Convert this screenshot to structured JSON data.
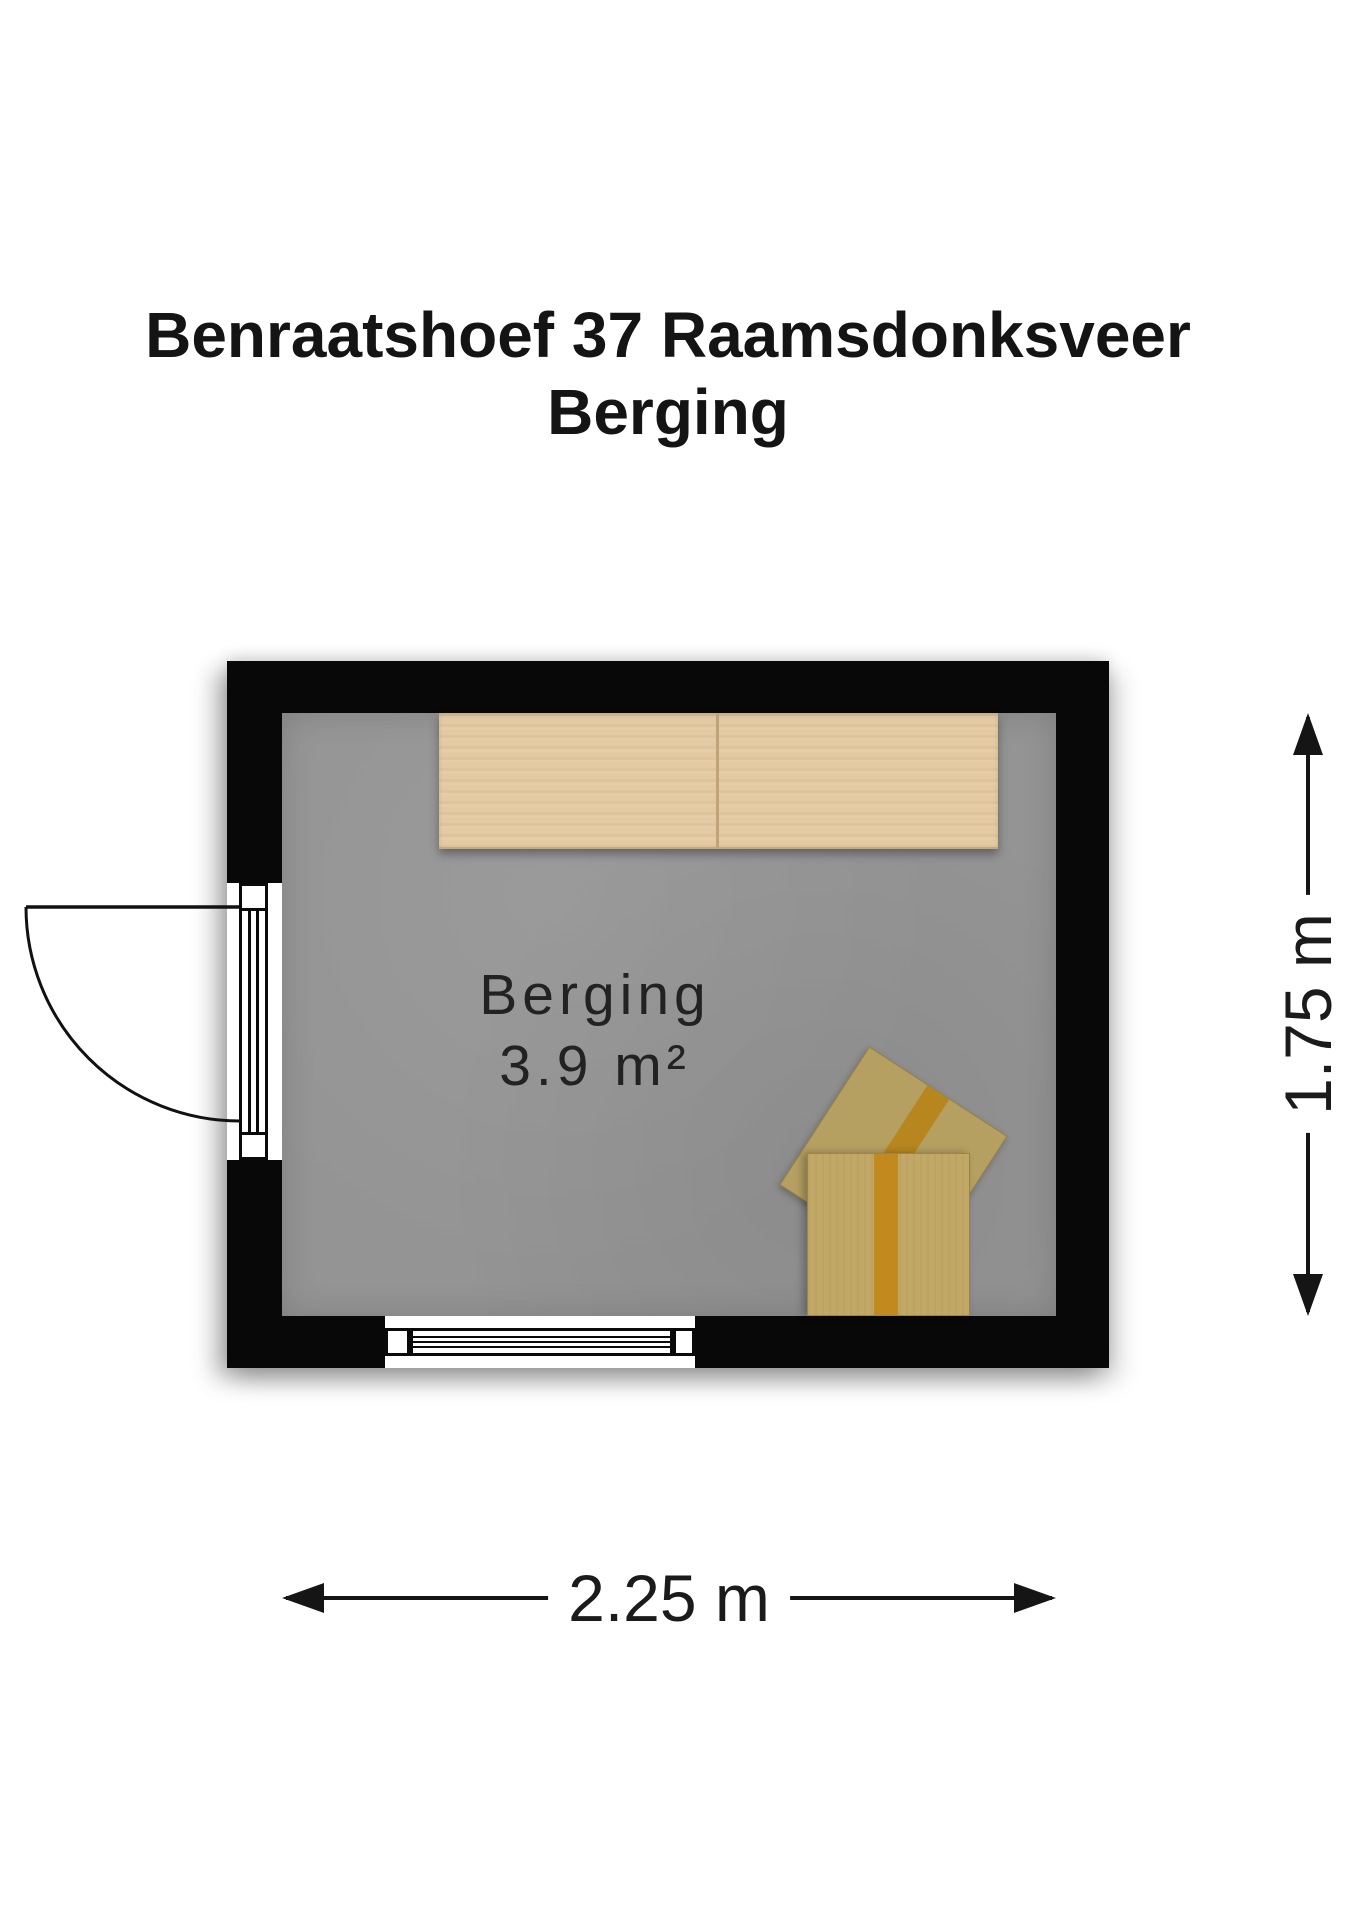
{
  "header": {
    "title_line1": "Benraatshoef 37 Raamsdonksveer",
    "title_line2": "Berging"
  },
  "room": {
    "name": "Berging",
    "area": "3.9 m²"
  },
  "dimensions": {
    "width": "2.25 m",
    "height": "1.75 m"
  },
  "objects": {
    "shelf": "wooden-storage-shelf",
    "boxes": "cardboard-moving-boxes",
    "door": "door-left-wall-outward-swing",
    "window": "window-bottom-wall"
  },
  "colors": {
    "wall": "#080808",
    "floor": "#949494",
    "shelf_wood": "#e3caa3",
    "box_front": "#c1a866",
    "box_back": "#b5a061",
    "box_tape": "#c28a1e",
    "text": "#1b1b1b",
    "background": "#ffffff"
  }
}
